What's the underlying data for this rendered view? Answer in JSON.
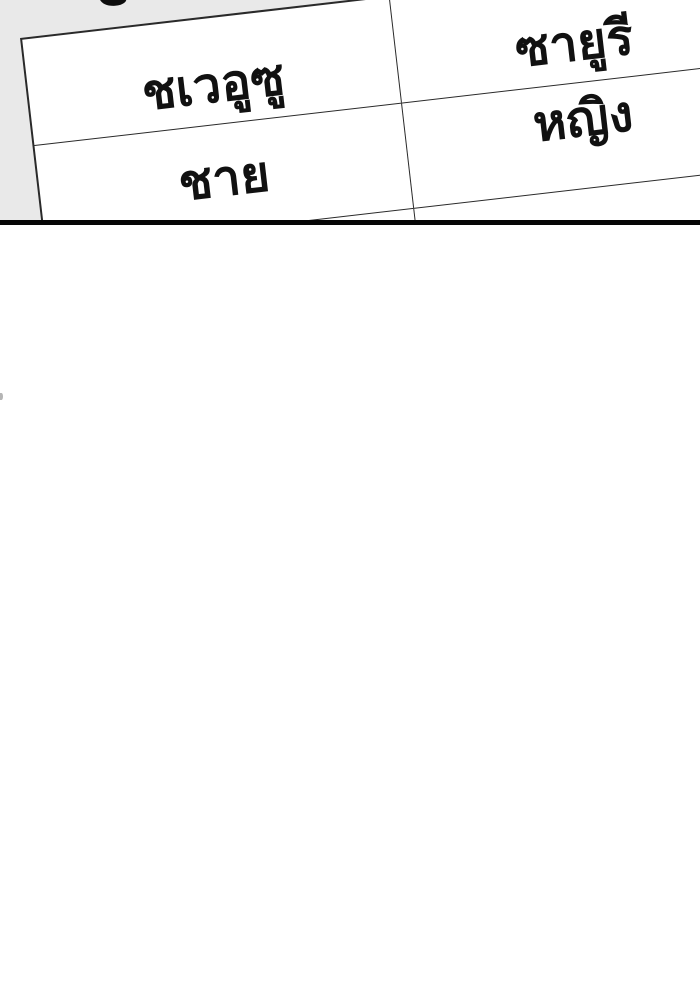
{
  "table": {
    "rows": [
      {
        "cells": [
          "ชเวอูซู",
          "ซายูรี"
        ]
      },
      {
        "cells": [
          "ชาย",
          "หญิง"
        ]
      },
      {
        "cells": [
          "",
          ""
        ]
      }
    ]
  },
  "colors": {
    "page_background": "#ffffff",
    "panel_background": "#e9e9e9",
    "table_cell_background": "#ffffff",
    "table_border": "#2a2a2a",
    "panel_divider_line": "#060606",
    "text": "#111111"
  }
}
